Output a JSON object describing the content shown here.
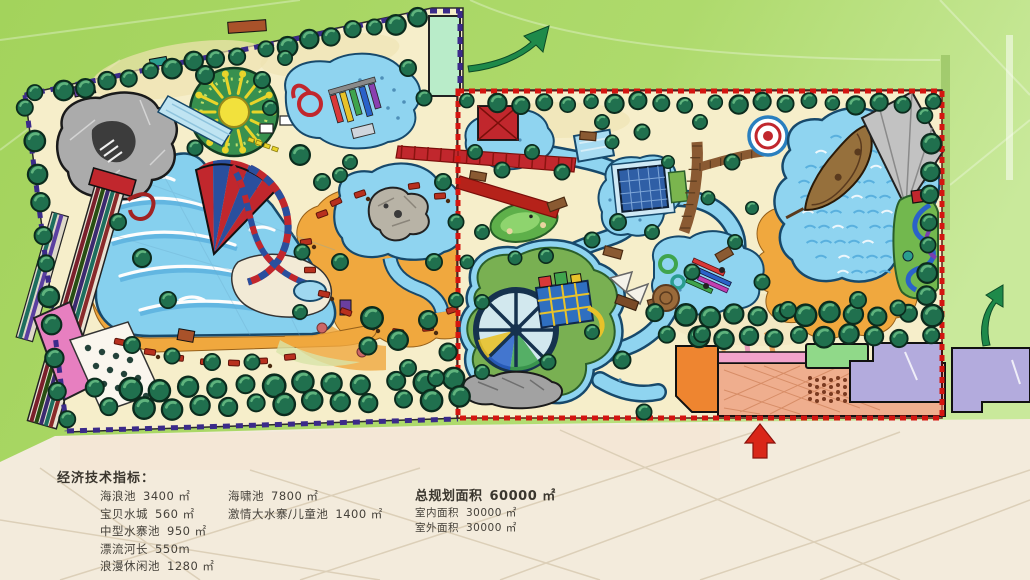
{
  "legend": {
    "title": "经济技术指标：",
    "col1": [
      {
        "label": "海浪池",
        "value": "3400 ㎡"
      },
      {
        "label": "宝贝水城",
        "value": "560 ㎡"
      },
      {
        "label": "中型水寨池",
        "value": "950 ㎡"
      },
      {
        "label": "漂流河长",
        "value": "550m"
      },
      {
        "label": "浪漫休闲池",
        "value": "1280 ㎡"
      }
    ],
    "col2": [
      {
        "label": "海啸池",
        "value": "7800 ㎡"
      },
      {
        "label": "激情大水寨/儿童池",
        "value": "1400 ㎡"
      }
    ],
    "total": {
      "label": "总规划面积",
      "value": "60000 ㎡"
    },
    "sub": [
      {
        "label": "室内面积",
        "value": "30000 ㎡"
      },
      {
        "label": "室外面积",
        "value": "30000 ㎡"
      }
    ]
  },
  "icons": [
    {
      "name": "exit-arrow-north",
      "glyph": "curved-arrow",
      "color": "#1e8a4a"
    },
    {
      "name": "exit-arrow-east",
      "glyph": "curved-arrow",
      "color": "#1e8a4a"
    },
    {
      "name": "entrance-arrow",
      "glyph": "arrow-up",
      "color": "#d92618"
    }
  ],
  "palette": {
    "background_green": "#a9d763",
    "paper_cream": "#f3ebdc",
    "park_sand": "#f6eeca",
    "water_blue": "#8fd4f0",
    "beach_orange": "#f0a83e",
    "tree_green": "#20704e",
    "zone_outdoor_border": "#3b2a8a",
    "zone_indoor_border": "#d41510",
    "building_pink": "#e77fc0",
    "building_mint": "#b9ecc9",
    "building_orange": "#ee8530",
    "building_lavender": "#b3abdd",
    "building_green": "#90d989",
    "plaza_salmon": "#efae8e"
  }
}
